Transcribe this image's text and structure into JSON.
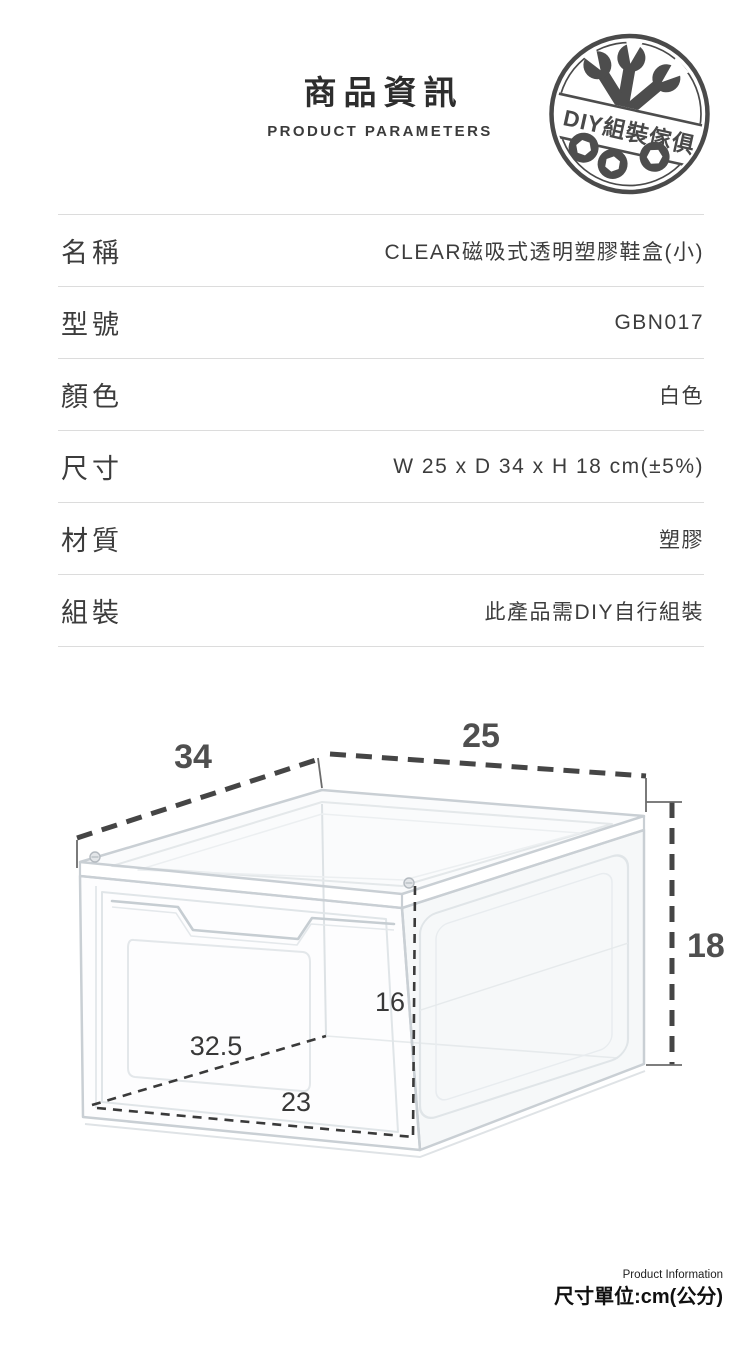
{
  "header": {
    "title": "商品資訊",
    "subtitle": "PRODUCT PARAMETERS",
    "badge_text": "DIY組裝傢俱"
  },
  "table": {
    "rows": [
      {
        "label": "名稱",
        "value": "CLEAR磁吸式透明塑膠鞋盒(小)"
      },
      {
        "label": "型號",
        "value": "GBN017"
      },
      {
        "label": "顏色",
        "value": "白色"
      },
      {
        "label": "尺寸",
        "value": "W 25 x D 34 x H 18 cm(±5%)"
      },
      {
        "label": "材質",
        "value": "塑膠"
      },
      {
        "label": "組裝",
        "value": "此產品需DIY自行組裝"
      }
    ]
  },
  "diagram": {
    "unit": "cm",
    "outer_depth": "34",
    "outer_width": "25",
    "outer_height": "18",
    "inner_height": "16",
    "inner_depth": "32.5",
    "inner_width": "23"
  },
  "footer": {
    "small_text": "Product Information",
    "unit_text": "尺寸單位:cm(公分)"
  },
  "colors": {
    "accent_dark": "#4a4a4a",
    "text_dark": "#2d2d2d",
    "table_text": "#3c3c3c",
    "divider": "#dcdcdc",
    "box_line": "#c9cfd4",
    "dim_line": "#454545"
  }
}
